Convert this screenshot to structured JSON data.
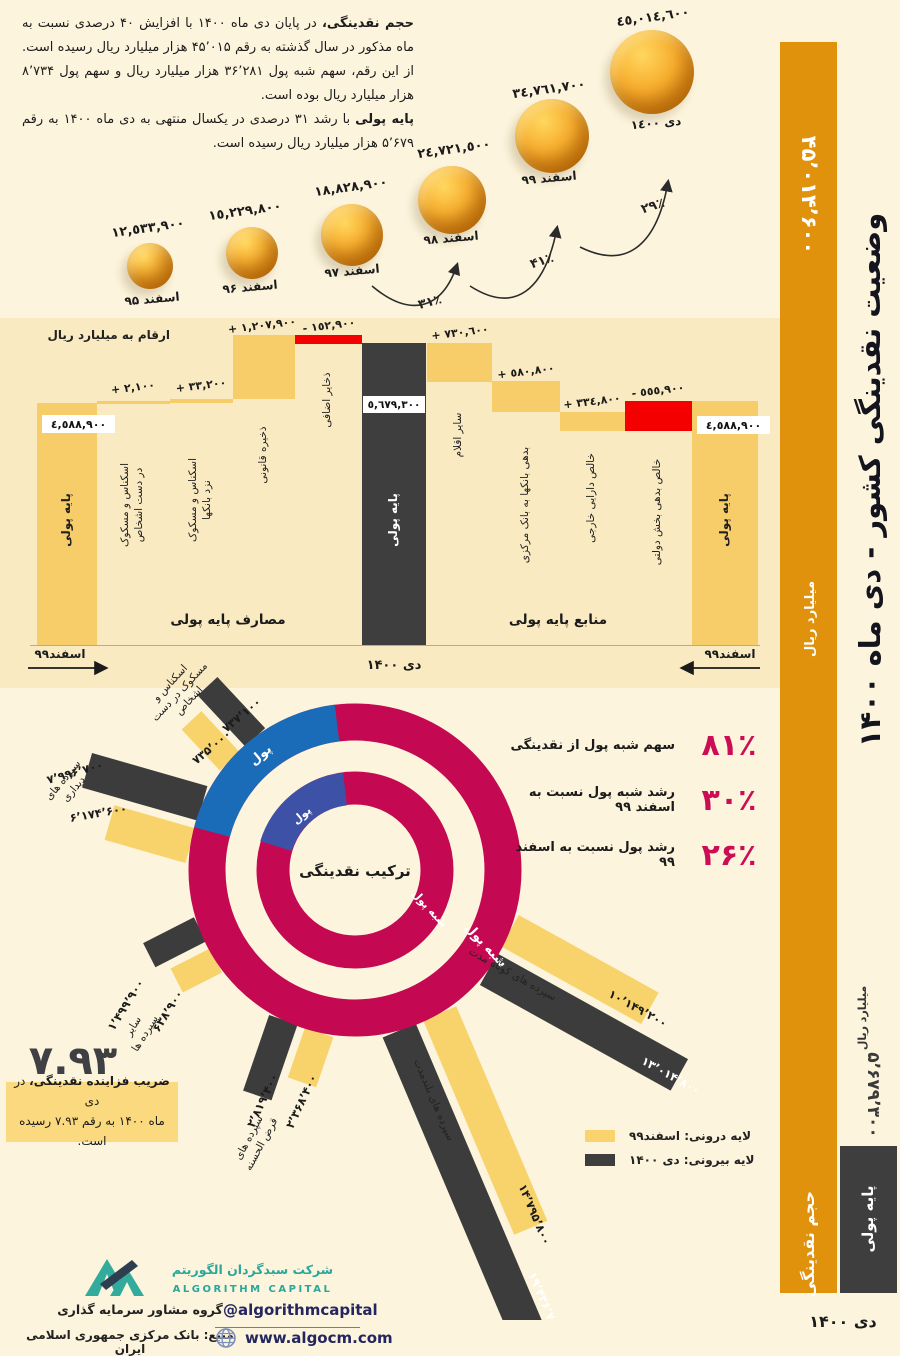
{
  "meta": {
    "title": "وضعیت نقدینگی کشور - دی ماه ۱۴۰۰"
  },
  "intro": {
    "lead1": "حجم نقدینگی،",
    "body1": " در پایان دی ماه ۱۴۰۰ با افزایش ۴۰ درصدی نسبت به ماه مذکور در سال گذشته به رقم ۴۵٬۰۱۵ هزار میلیارد ریال رسیده است. از این رقم، سهم شبه پول ۳۶٬۲۸۱ هزار میلیارد ریال و سهم پول ۸٬۷۳۴ هزار میلیارد ریال بوده است.",
    "lead2": "پایه پولی",
    "body2": " با رشد ۳۱ درصدی در یکسال منتهی به دی ماه ۱۴۰۰ به رقم ۵٬۶۷۹ هزار میلیارد ریال رسیده است."
  },
  "bubbles": {
    "items": [
      {
        "month": "اسفند ۹۵",
        "value": "١٢,٥٣٣,٩٠٠"
      },
      {
        "month": "اسفند ۹۶",
        "value": "١٥,٢٢٩,٨٠٠"
      },
      {
        "month": "اسفند ۹۷",
        "value": "١٨,٨٢٨,٩٠٠"
      },
      {
        "month": "اسفند ۹۸",
        "value": "٢٤,٧٢١,٥٠٠"
      },
      {
        "month": "اسفند ۹۹",
        "value": "٣٤,٧٦١,٧٠٠"
      },
      {
        "month": "دی ١٤٠٠",
        "value": "٤٥,٠١٤,٦٠٠"
      }
    ],
    "arrows": [
      "۳۱٪",
      "۴۱٪",
      "۲۹٪"
    ]
  },
  "waterfall": {
    "note": "ارقام به میلیارد ریال",
    "uses_title": "مصارف پایه پولی",
    "sources_title": "منابع پایه پولی",
    "axis_left": "اسفند۹۹",
    "axis_center": "دی ۱۴۰۰",
    "axis_right": "اسفند۹۹",
    "base_left": {
      "label": "پایه پولی",
      "value": "٤,٥٨٨,٩٠٠"
    },
    "center": {
      "label": "پایه پولی",
      "value": "٥,٦٧٩,٣٠٠"
    },
    "base_right": {
      "label": "پایه پولی",
      "value": "٤,٥٨٨,٩٠٠"
    },
    "uses": [
      {
        "label": "اسکناس و مسکوک",
        "label2": "در دست اشخاص",
        "value": "٢,١٠٠ +"
      },
      {
        "label": "اسکناس و مسکوک",
        "label2": "نزد بانکها",
        "value": "٣٣,٢٠٠ +"
      },
      {
        "label": "ذخیره قانونی",
        "value": "١,٢٠٧,٩٠٠ +"
      },
      {
        "label": "ذخایر اضافی",
        "value": "١٥٢,٩٠٠ -"
      }
    ],
    "sources": [
      {
        "label": "سایر اقلام",
        "value": "٧٣٠,٦٠٠ +"
      },
      {
        "label": "بدهی بانکها به بانک مرکزی",
        "value": "٥٨٠,٨٠٠ +"
      },
      {
        "label": "خالص دارایی خارجی",
        "value": "٣٣٤,٨٠٠ +"
      },
      {
        "label": "خالص بدهی بخش دولتی",
        "value": "٥٥٥,٩٠٠ -"
      }
    ]
  },
  "donut": {
    "center_label": "ترکیب نقدینگی",
    "outer_money": "پول",
    "inner_money": "پول",
    "outer_quasi": "شبه پول",
    "inner_quasi": "شبه پول",
    "stats": [
      {
        "value": "۸۱٪",
        "label": "سهم شبه پول از نقدینگی"
      },
      {
        "value": "۳۰٪",
        "label": "رشد شبه پول نسبت به اسفند ۹۹"
      },
      {
        "value": "۲۶٪",
        "label": "رشد پول نسبت به اسفند ۹۹"
      }
    ],
    "legend": [
      {
        "label": "لایه درونی:  اسفند۹۹"
      },
      {
        "label": "لایه بیرونی:  دی ۱۴۰۰"
      }
    ],
    "bars": [
      {
        "name": "اسکناس و",
        "name2": "مسکوک در دست",
        "name3": "اشخاص",
        "dark": "۷۳۷٬۱۰۰",
        "yellow": "۷۳۵٬۰۰۰"
      },
      {
        "name": "سپرده های",
        "name2": "دیداری",
        "dark": "۷٬۹۹۶٬۷۰۰",
        "yellow": "۶٬۱۷۴٬۶۰۰"
      },
      {
        "name": "سایر",
        "name2": "سپرده ها",
        "dark": "۱٬۴۹۹٬۹۰۰",
        "yellow": "۶۳۸٬۹۰۰"
      },
      {
        "name": "سپرده های",
        "name2": "قرض الحسنه",
        "dark": "۲٬۸۱۹٬۴۰۰",
        "yellow": "۲٬۳۶۸٬۴۰۰"
      },
      {
        "name": "سپرده های بلندمدت",
        "dark": "۱۹٬۴۳۶٬۷۰۰",
        "yellow": "۱۴٬۷۹۵٬۸۰۰"
      },
      {
        "name": "سپرده های کوتاه مدت",
        "dark": "۱۳٬۰۱۴٬۸۰۰",
        "yellow": "۱۰٬۱۴۹٬۲۰۰"
      }
    ]
  },
  "multiplier": {
    "value": "۷.۹۳",
    "lead": "ضریب فزاینده نقدینگی،",
    "rest1": " در دی",
    "line2": "ماه ۱۴۰۰ به رقم ۷.۹۳ رسیده است."
  },
  "sidebar": {
    "title": "وضعیت نقدینگی کشور - دی ماه ۱۴۰۰",
    "m2_value": "۴۵٬۰۱۴٬۶۰۰",
    "m2_unit": "میلیارد ریال",
    "m2_label": "حجم نقدینگی",
    "base_value": "۵٬۶۷۹٬۳۰۰",
    "base_unit": "میلیارد ریال",
    "base_label": "پایه پولی",
    "period": "دی ۱۴۰۰"
  },
  "footer": {
    "company_fa": "شرکت سبدگردان الگوریتم",
    "company_en": "ALGORITHM CAPITAL",
    "tagline": "گروه مشاور سرمایه گذاری",
    "source": "منبع: بانک مرکزی جمهوری اسلامی ایران",
    "telegram": "@algorithmcapital",
    "website": "www.algocm.com"
  },
  "colors": {
    "accent_orange": "#E1920D",
    "bar_yellow": "#F6CD68",
    "bar_dark": "#3E3E3E",
    "negative_red": "#F40000",
    "ring_crimson": "#C40851",
    "ring_blue_outer": "#1B6CB8",
    "ring_blue_inner": "#3D52A6",
    "stat_crimson": "#CC0D56",
    "logo_teal": "#2AA79B"
  },
  "chart_data": [
    {
      "type": "scatter",
      "subtype": "bubble-growth",
      "title": "حجم نقدینگی",
      "ylabel": "میلیارد ریال",
      "categories": [
        "اسفند ۹۵",
        "اسفند ۹۶",
        "اسفند ۹۷",
        "اسفند ۹۸",
        "اسفند ۹۹",
        "دی ۱۴۰۰"
      ],
      "values": [
        12533900,
        15229800,
        18828900,
        24721500,
        34761700,
        45014600
      ],
      "growth_annotations": [
        {
          "from": "اسفند ۹۷",
          "to": "اسفند ۹۸",
          "growth": "31%"
        },
        {
          "from": "اسفند ۹۸",
          "to": "اسفند ۹۹",
          "growth": "41%"
        },
        {
          "from": "اسفند ۹۹",
          "to": "دی ۱۴۰۰",
          "growth": "29%"
        }
      ]
    },
    {
      "type": "bar",
      "subtype": "waterfall",
      "title": "منابع و مصارف پایه پولی",
      "unit": "میلیارد ریال",
      "start": {
        "label": "پایه پولی اسفند ۹۹",
        "value": 4588900
      },
      "uses_steps": [
        {
          "label": "اسکناس و مسکوک در دست اشخاص",
          "value": 2100
        },
        {
          "label": "اسکناس و مسکوک نزد بانکها",
          "value": 33200
        },
        {
          "label": "ذخیره قانونی",
          "value": 1207900
        },
        {
          "label": "ذخایر اضافی",
          "value": -152900
        }
      ],
      "sources_steps": [
        {
          "label": "سایر اقلام",
          "value": 730600
        },
        {
          "label": "بدهی بانکها به بانک مرکزی",
          "value": 580800
        },
        {
          "label": "خالص دارایی خارجی",
          "value": 334800
        },
        {
          "label": "خالص بدهی بخش دولتی",
          "value": -555900
        }
      ],
      "end": {
        "label": "پایه پولی دی ۱۴۰۰",
        "value": 5679300
      }
    },
    {
      "type": "pie",
      "title": "ترکیب نقدینگی",
      "slices": [
        {
          "label": "شبه پول",
          "value": 81
        },
        {
          "label": "پول",
          "value": 19
        }
      ],
      "notes": [
        {
          "label": "سهم شبه پول از نقدینگی",
          "value": "81%"
        },
        {
          "label": "رشد شبه پول نسبت به اسفند ۹۹",
          "value": "30%"
        },
        {
          "label": "رشد پول نسبت به اسفند ۹۹",
          "value": "26%"
        }
      ]
    },
    {
      "type": "bar",
      "subtype": "radial",
      "title": "اجزای نقدینگی",
      "unit": "میلیارد ریال",
      "categories": [
        "اسکناس و مسکوک در دست اشخاص",
        "سپرده های دیداری",
        "سایر سپرده ها",
        "سپرده های قرض الحسنه",
        "سپرده های بلندمدت",
        "سپرده های کوتاه مدت"
      ],
      "series": [
        {
          "name": "دی ۱۴۰۰",
          "values": [
            737100,
            7996700,
            1499900,
            2819400,
            19436700,
            13014800
          ]
        },
        {
          "name": "اسفند ۹۹",
          "values": [
            735000,
            6174600,
            638900,
            2368400,
            14795800,
            10149200
          ]
        }
      ],
      "legend_position": "bottom-right"
    },
    {
      "type": "bar",
      "title": "دی ۱۴۰۰",
      "unit": "میلیارد ریال",
      "categories": [
        "حجم نقدینگی",
        "پایه پولی"
      ],
      "values": [
        45014600,
        5679300
      ],
      "money_multiplier": 7.93
    }
  ]
}
